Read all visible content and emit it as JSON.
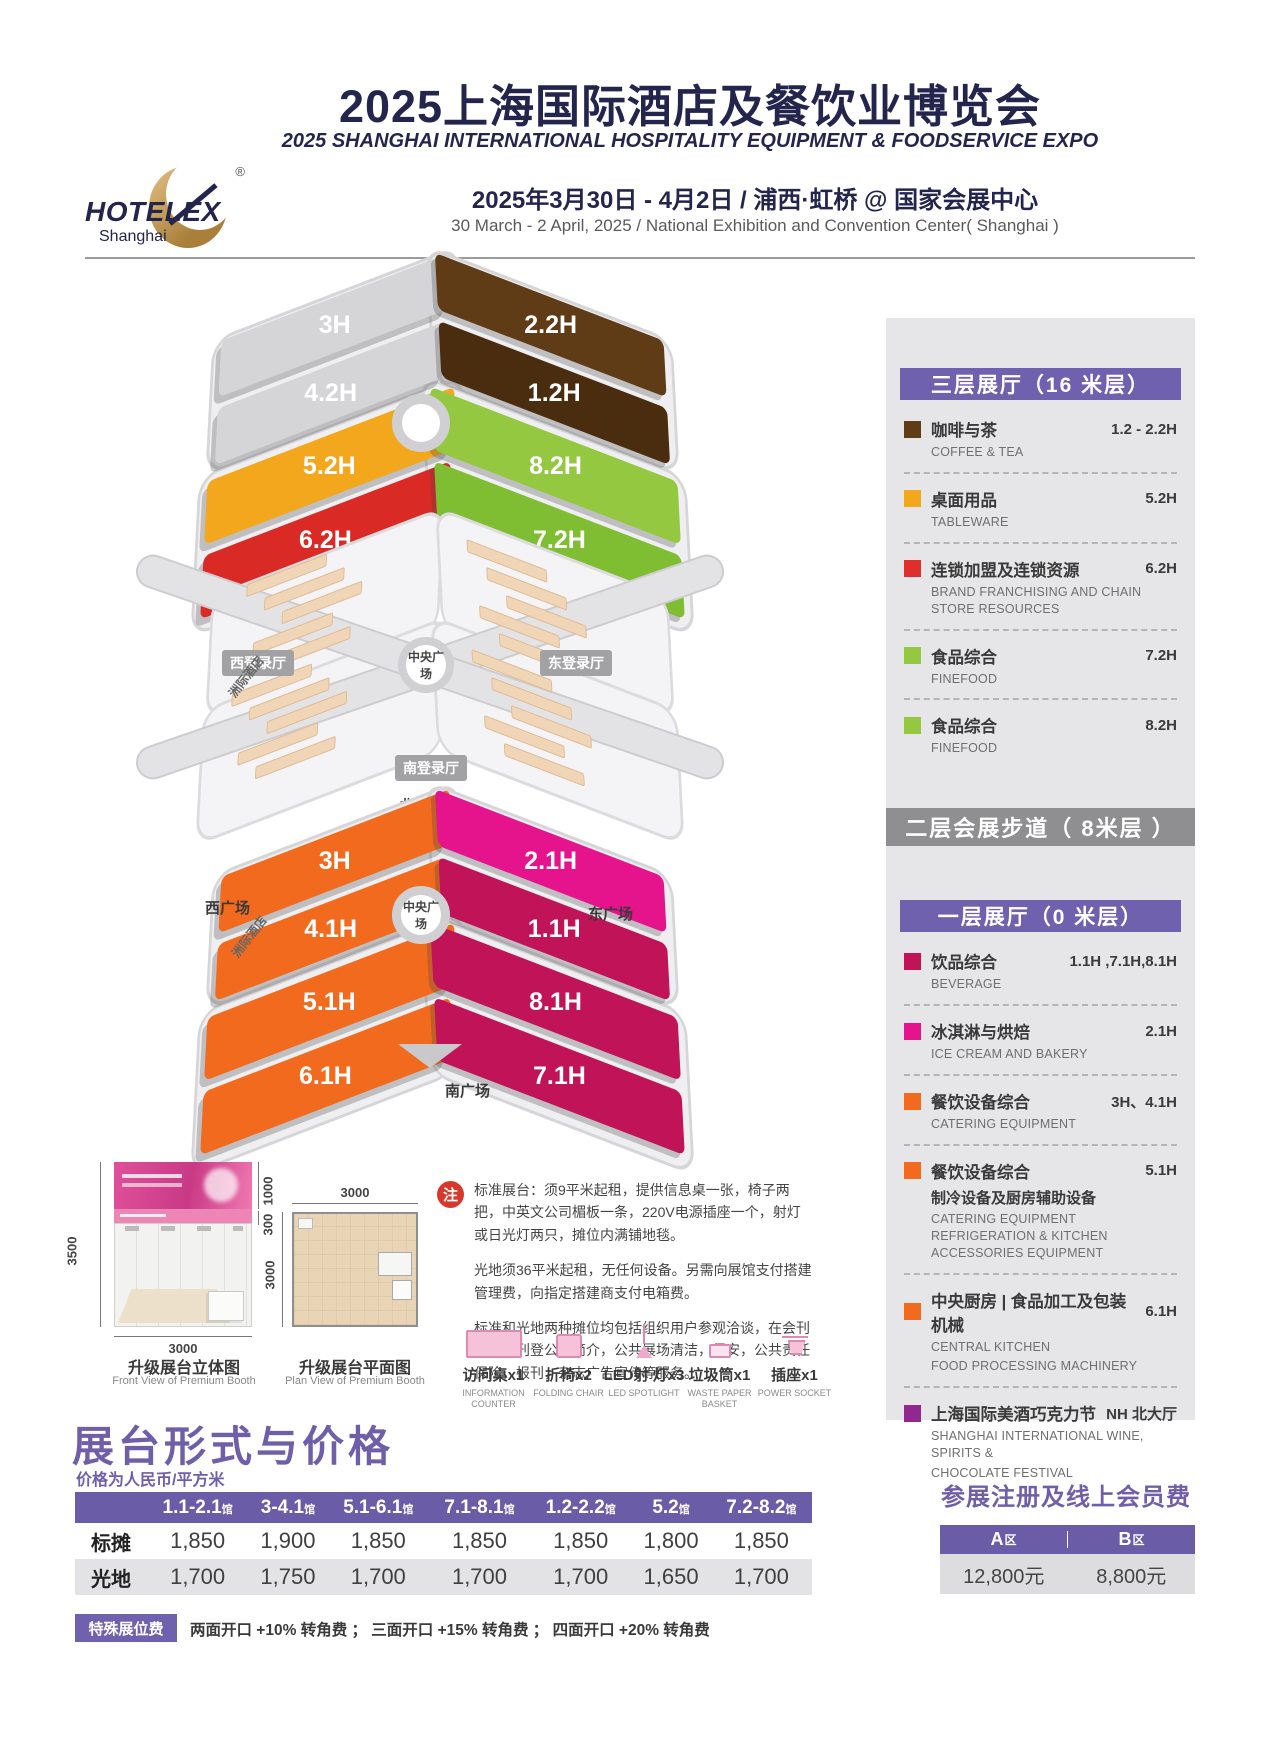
{
  "header": {
    "title_cn": "2025上海国际酒店及餐饮业博览会",
    "title_en": "2025 SHANGHAI INTERNATIONAL HOSPITALITY EQUIPMENT & FOODSERVICE EXPO",
    "date_cn": "2025年3月30日 - 4月2日 / 浦西·虹桥 @ 国家会展中心",
    "date_en": "30 March - 2 April, 2025 / National Exhibition and Convention Center( Shanghai )",
    "logo": {
      "word": "HOTELEX",
      "sub": "Shanghai",
      "reg": "®"
    }
  },
  "colors": {
    "navy": "#23254d",
    "purple": "#6f61ad",
    "hall_gray": "#d5d5d7",
    "brown": "#5f3b16",
    "brown_dark": "#4a2c0e",
    "yellow": "#f2a71d",
    "red": "#da2a26",
    "green": "#93c840",
    "green_dark": "#7fbe33",
    "orange": "#f26a1e",
    "magenta": "#e5148c",
    "raspberry": "#c01358",
    "wine": "#92278f",
    "legend_red": "#dd2f2b",
    "north_purple": "#7c2d80"
  },
  "floorplan": {
    "upper_halls": [
      "3H",
      "4.2H",
      "2.2H",
      "1.2H",
      "5.2H",
      "6.2H",
      "8.2H",
      "7.2H"
    ],
    "lower_halls": [
      "3H",
      "4.1H",
      "2.1H",
      "1.1H",
      "5.1H",
      "6.1H",
      "8.1H",
      "7.1H"
    ],
    "labels": {
      "west_hall": "西登录厅",
      "east_hall": "东登录厅",
      "south_hall": "南登录厅",
      "north_hall": "北登录厅",
      "central_plaza": "中央广场",
      "west_plaza": "西广场",
      "east_plaza": "东广场",
      "south_plaza": "南广场",
      "hotel": "洲际酒店"
    }
  },
  "legend": {
    "f3_title": "三层展厅（16 米层）",
    "walkway_title": "二层会展步道（ 8米层 ）",
    "f1_title": "一层展厅（0 米层）",
    "f3": {
      "items": [
        {
          "cn": "咖啡与茶",
          "en": "COFFEE & TEA",
          "halls": "1.2 - 2.2H"
        },
        {
          "cn": "桌面用品",
          "en": "TABLEWARE",
          "halls": "5.2H"
        },
        {
          "cn": "连锁加盟及连锁资源",
          "en": "BRAND FRANCHISING AND CHAIN STORE RESOURCES",
          "halls": "6.2H"
        },
        {
          "cn": "食品综合",
          "en": "FINEFOOD",
          "halls": "7.2H"
        },
        {
          "cn": "食品综合",
          "en": "FINEFOOD",
          "halls": "8.2H"
        }
      ]
    },
    "f1": {
      "items": [
        {
          "cn": "饮品综合",
          "en": "BEVERAGE",
          "halls": "1.1H ,7.1H,8.1H"
        },
        {
          "cn": "冰淇淋与烘焙",
          "en": "ICE CREAM AND BAKERY",
          "halls": "2.1H"
        },
        {
          "cn": "餐饮设备综合",
          "en": "CATERING EQUIPMENT",
          "halls": "3H、4.1H"
        },
        {
          "cn": "餐饮设备综合",
          "cn2": "制冷设备及厨房辅助设备",
          "en": "CATERING EQUIPMENT REFRIGERATION & KITCHEN ACCESSORIES EQUIPMENT",
          "halls": "5.1H"
        },
        {
          "cn": "中央厨房 | 食品加工及包装机械",
          "en": "CENTRAL KITCHEN",
          "en2": "FOOD PROCESSING MACHINERY",
          "halls": "6.1H"
        },
        {
          "cn": "上海国际美酒巧克力节",
          "en": "SHANGHAI INTERNATIONAL WINE, SPIRITS &",
          "en2": "CHOCOLATE FESTIVAL",
          "halls": "NH 北大厅"
        }
      ]
    }
  },
  "booth": {
    "front_caption_cn": "升级展台立体图",
    "front_caption_en": "Front View of Premium Booth",
    "plan_caption_cn": "升级展台平面图",
    "plan_caption_en": "Plan View of Premium Booth",
    "dim_3500": "3500",
    "dim_1000": "1000",
    "dim_300": "300",
    "dim_3000": "3000"
  },
  "notes": {
    "badge": "注",
    "p1": "标准展台：须9平米起租，提供信息桌一张，椅子两把，中英文公司楣板一条，220V电源插座一个，射灯或日光灯两只，摊位内满铺地毯。",
    "p2": "光地须36平米起租，无任何设备。另需向展馆支付搭建管理费，向指定搭建商支付电箱费。",
    "p3": "标准和光地两种摊位均包括组织用户参观洽谈，在会刊内免费刊登公司简介，公共展场清洁，保安，公共责任保险，报刊，杂志广告宣传等服务。"
  },
  "furniture": [
    {
      "cn": "访问桌x1",
      "en": "INFORMATION COUNTER"
    },
    {
      "cn": "折椅x2",
      "en": "FOLDING CHAIR"
    },
    {
      "cn": "LED射 灯x3",
      "en": "LED SPOTLIGHT"
    },
    {
      "cn": "垃圾筒x1",
      "en": "WASTE PAPER BASKET"
    },
    {
      "cn": "插座x1",
      "en": "POWER SOCKET"
    }
  ],
  "pricing": {
    "title": "展台形式与价格",
    "subtitle": "价格为人民币/平方米",
    "col_suffix": "馆",
    "cols": [
      "1.1-2.1",
      "3-4.1",
      "5.1-6.1",
      "7.1-8.1",
      "1.2-2.2",
      "5.2",
      "7.2-8.2"
    ],
    "rows": [
      {
        "label": "标摊",
        "values": [
          "1,850",
          "1,900",
          "1,850",
          "1,850",
          "1,850",
          "1,800",
          "1,850"
        ]
      },
      {
        "label": "光地",
        "values": [
          "1,700",
          "1,750",
          "1,700",
          "1,700",
          "1,700",
          "1,650",
          "1,700"
        ]
      }
    ]
  },
  "registration": {
    "title": "参展注册及线上会员费",
    "a_label": "A",
    "b_label": "B",
    "zone_suffix": "区",
    "a_value": "12,800元",
    "b_value": "8,800元"
  },
  "special": {
    "badge": "特殊展位费",
    "text": "两面开口 +10% 转角费 ； 三面开口 +15% 转角费 ； 四面开口 +20% 转角费"
  }
}
